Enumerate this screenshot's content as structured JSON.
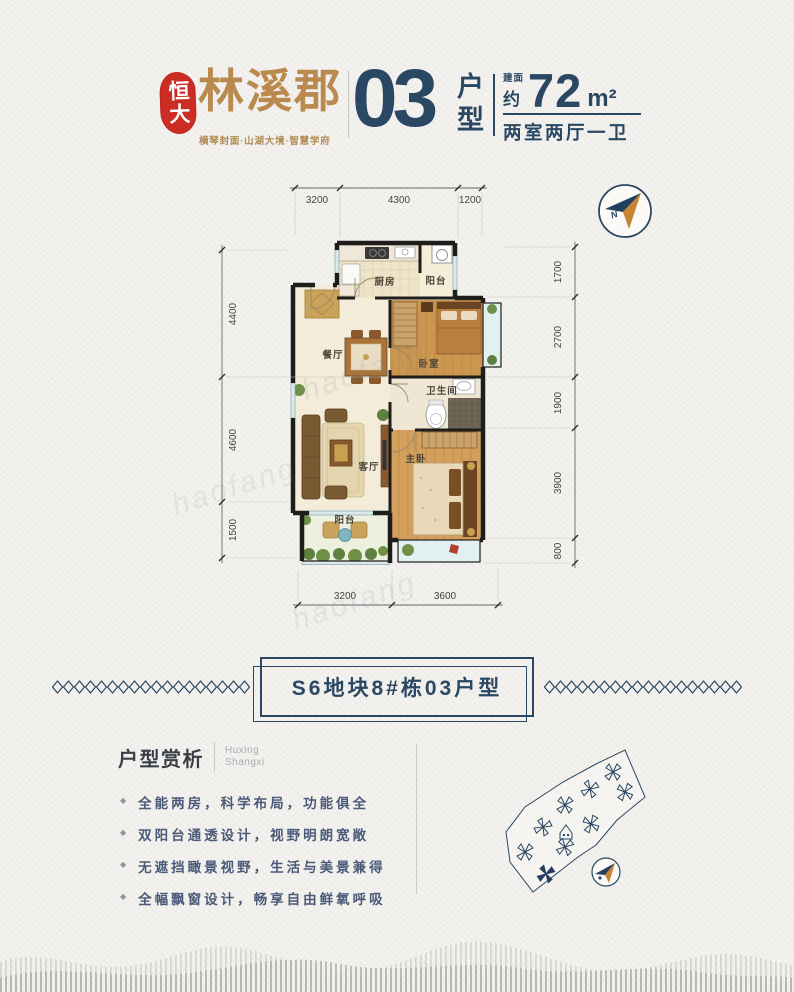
{
  "header": {
    "seal": "恒大",
    "brand": "林溪郡",
    "tagline": "横琴封面·山湖大境·智慧学府",
    "unit_number": "03",
    "unit_type_label": "户型",
    "area_label": "建面",
    "area_approx": "约",
    "area_value": "72",
    "area_unit": "m²",
    "layout_desc": "两室两厅一卫"
  },
  "plan": {
    "compass_n": "N",
    "watermark": "haofang",
    "rooms": {
      "kitchen": "厨房",
      "balcony_top": "阳台",
      "bedroom": "卧室",
      "dining": "餐厅",
      "bath": "卫生间",
      "living": "客厅",
      "master": "主卧",
      "balcony_bottom": "阳台"
    },
    "dims": {
      "top": [
        "3200",
        "4300",
        "1200"
      ],
      "bottom": [
        "3200",
        "3600"
      ],
      "left": [
        "4400",
        "4600",
        "1500"
      ],
      "right": [
        "1700",
        "2700",
        "1900",
        "3900",
        "800"
      ]
    }
  },
  "banner": {
    "title": "S6地块8#栋03户型"
  },
  "analysis": {
    "title": "户型赏析",
    "subtitle_lines": [
      "Huxing",
      "Shangxi"
    ],
    "bullets": [
      "全能两房，科学布局，功能俱全",
      "双阳台通透设计，视野明朗宽敞",
      "无遮挡瞰景视野，生活与美景兼得",
      "全幅飘窗设计，畅享自由鲜氧呼吸"
    ]
  },
  "colors": {
    "navy": "#2a4763",
    "gold": "#b9894e",
    "seal_red": "#cb2d24",
    "paper": "#f2f0ec",
    "wood": "#cb9650",
    "cream_floor": "#f2ecd8"
  }
}
